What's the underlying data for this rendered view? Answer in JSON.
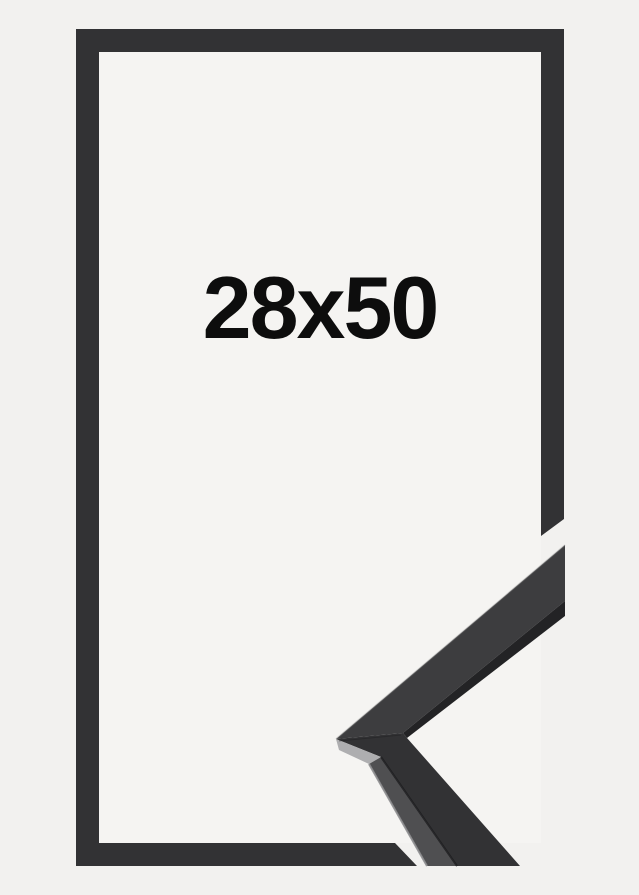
{
  "frame_product": {
    "size_label": "28x50"
  },
  "colors": {
    "background": "#f2f1ef",
    "frame_interior": "#f5f4f2",
    "frame_outline": "#323234",
    "label_text": "#0d0d0d",
    "sample_upper_face": "#3d3d3f",
    "sample_lower_face": "#323234",
    "sample_underside": "#232325",
    "sample_miter_facet": "#aeaeb0",
    "sample_side_strip": "#4f4f51",
    "edge_highlight": "#8e8e90",
    "edge_shadow": "#1c1c1e"
  }
}
